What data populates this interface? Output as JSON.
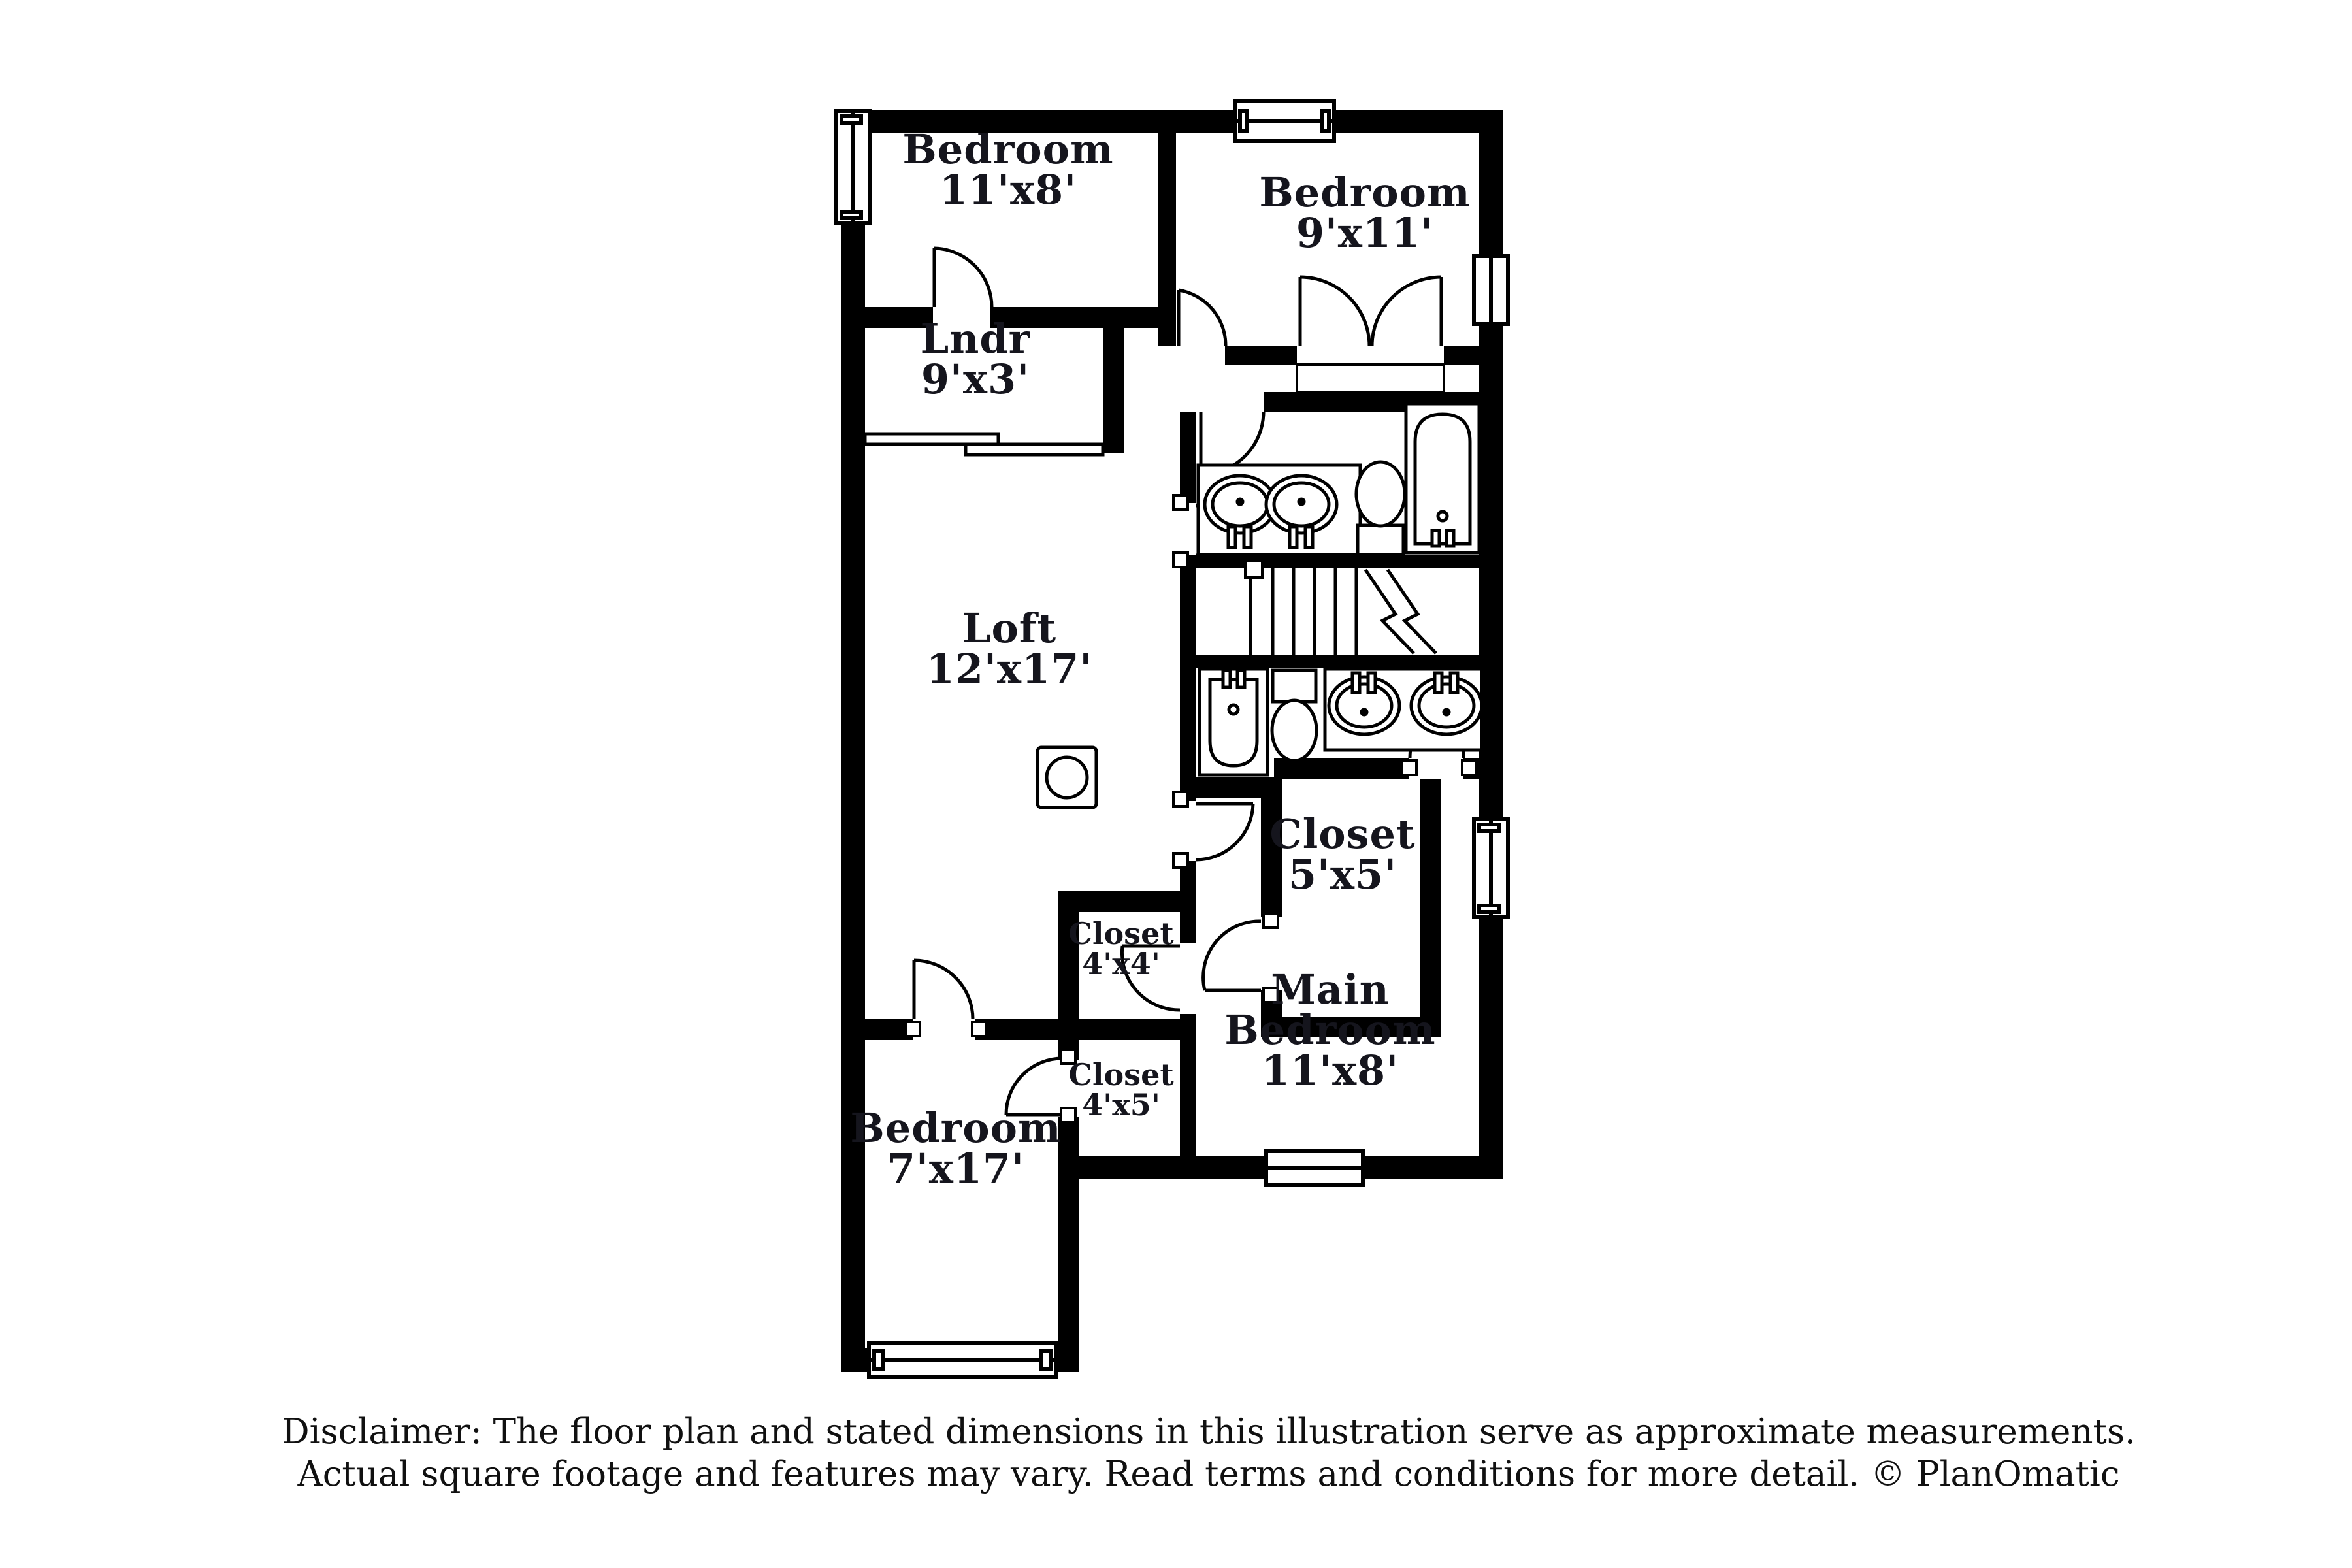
{
  "document_type": "floor-plan",
  "colors": {
    "background": "#ffffff",
    "walls": "#000000",
    "label_text": "#15151d"
  },
  "plan": {
    "labels": [
      {
        "id": "bedroom-top-left",
        "lines": [
          "Bedroom",
          "11'x8'"
        ],
        "room": "Bedroom",
        "dims": "11'x8'"
      },
      {
        "id": "bedroom-top-right",
        "lines": [
          "Bedroom",
          "9'x11'"
        ],
        "room": "Bedroom",
        "dims": "9'x11'"
      },
      {
        "id": "laundry",
        "lines": [
          "Lndr",
          "9'x3'"
        ],
        "room": "Lndr",
        "dims": "9'x3'"
      },
      {
        "id": "loft",
        "lines": [
          "Loft",
          "12'x17'"
        ],
        "room": "Loft",
        "dims": "12'x17'"
      },
      {
        "id": "closet-5x5",
        "lines": [
          "Closet",
          "5'x5'"
        ],
        "room": "Closet",
        "dims": "5'x5'"
      },
      {
        "id": "closet-4x4",
        "lines": [
          "Closet",
          "4'x4'"
        ],
        "room": "Closet",
        "dims": "4'x4'"
      },
      {
        "id": "main-bedroom",
        "lines": [
          "Main",
          "Bedroom",
          "11'x8'"
        ],
        "room": "Main Bedroom",
        "dims": "11'x8'"
      },
      {
        "id": "closet-4x5",
        "lines": [
          "Closet",
          "4'x5'"
        ],
        "room": "Closet",
        "dims": "4'x5'"
      },
      {
        "id": "bedroom-bottom",
        "lines": [
          "Bedroom",
          "7'x17'"
        ],
        "room": "Bedroom",
        "dims": "7'x17'"
      }
    ],
    "fixtures": [
      "bathtub-icon",
      "bathtub-icon",
      "toilet-icon",
      "toilet-icon",
      "sink-icon",
      "sink-icon",
      "sink-icon",
      "sink-icon",
      "staircase",
      "sliding-door",
      "window",
      "appliance-icon"
    ],
    "window_count": 6,
    "door_count": 11
  },
  "disclaimer": {
    "line1": "Disclaimer: The floor plan and stated dimensions in this illustration serve as approximate measurements.",
    "line2": "Actual square footage and features may vary. Read terms and conditions for more detail. © PlanOmatic"
  }
}
